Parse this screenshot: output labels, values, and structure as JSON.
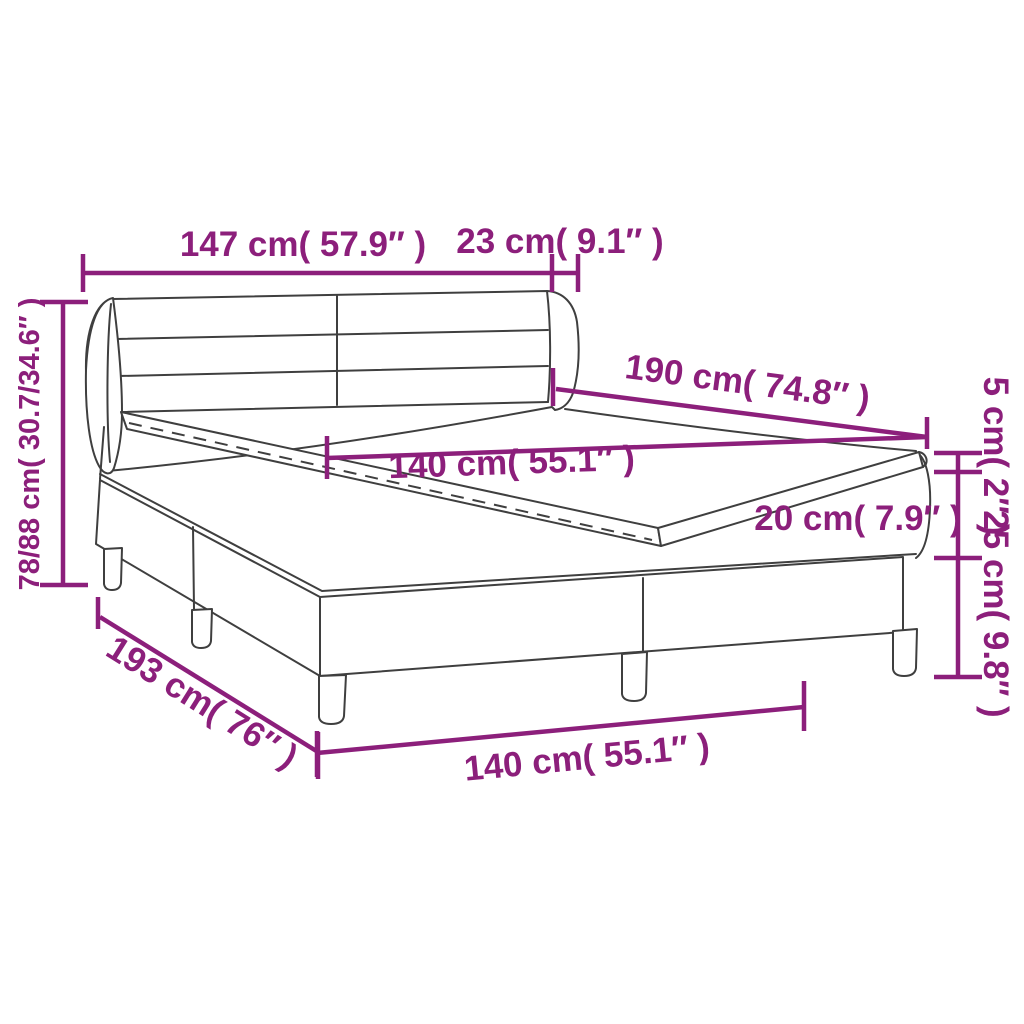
{
  "diagram": {
    "type": "furniture-dimension-diagram",
    "subject": "box spring bed with headboard, topper, mattress and split base on legs",
    "colors": {
      "dimension_color": "#8C1F7B",
      "outline_color": "#3F3F3F",
      "background": "#FFFFFF"
    },
    "labels": {
      "headboard_width": "147 cm( 57.9″ )",
      "headboard_depth": "23 cm( 9.1″ )",
      "total_height": "78/88 cm( 30.7/34.6″ )",
      "bed_length": "190 cm( 74.8″ )",
      "mattress_width": "140 cm( 55.1″ )",
      "topper_thickness": "5 cm( 2″ )",
      "mattress_thickness": "20 cm( 7.9″ )",
      "base_height": "25 cm( 9.8″ )",
      "base_length": "193 cm( 76″ )",
      "base_width": "140 cm( 55.1″ )"
    }
  }
}
